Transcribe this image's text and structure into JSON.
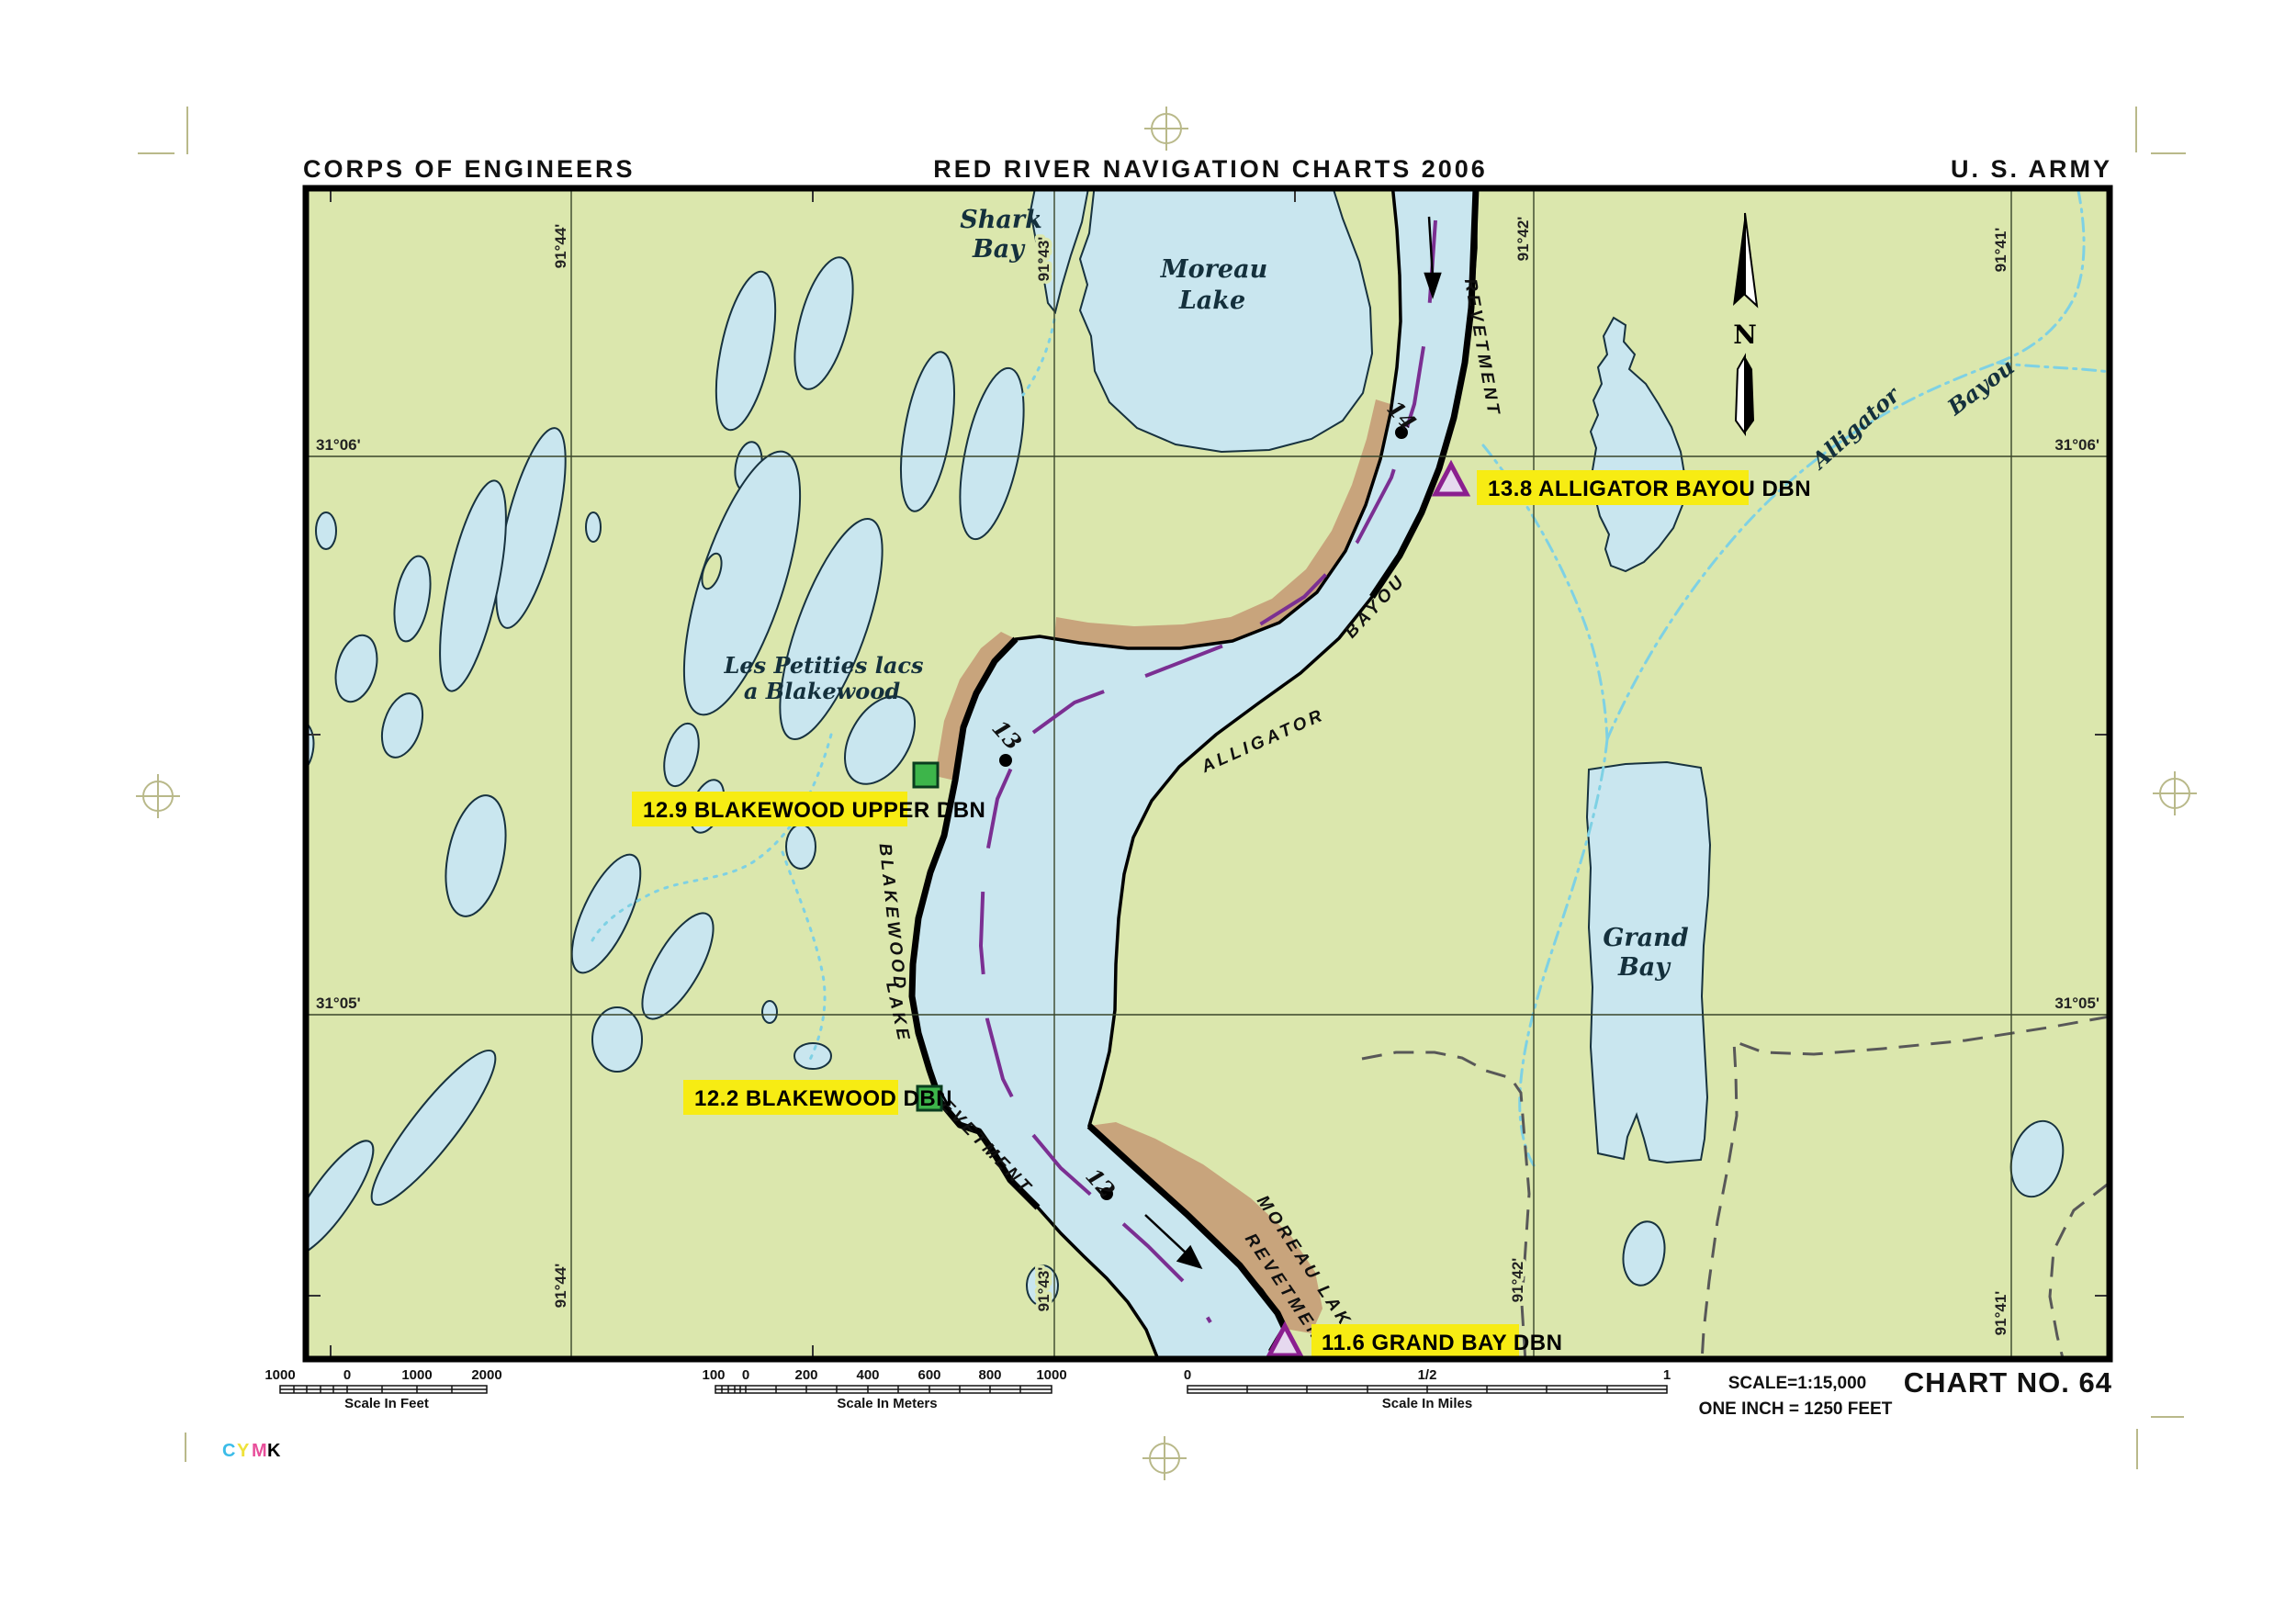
{
  "header": {
    "left": "CORPS OF ENGINEERS",
    "center": "RED RIVER NAVIGATION CHARTS 2006",
    "right": "U. S. ARMY"
  },
  "footer": {
    "scale_text": "SCALE=1:15,000",
    "inch_text": "ONE INCH = 1250 FEET",
    "chart_no": "CHART NO. 64",
    "cymk": {
      "c": "C",
      "y": "Y",
      "m": "M",
      "k": "K"
    }
  },
  "compass": {
    "north": "N"
  },
  "grid": {
    "lat": [
      "31°06'",
      "31°05'"
    ],
    "lon": [
      "91°44'",
      "91°43'",
      "91°42'",
      "91°41'"
    ]
  },
  "places": {
    "shark_bay": {
      "line1": "Shark",
      "line2": "Bay"
    },
    "moreau_lake": {
      "line1": "Moreau",
      "line2": "Lake"
    },
    "les_petities": {
      "line1": "Les Petities lacs",
      "line2": "a Blakewood"
    },
    "grand_bay": {
      "line1": "Grand",
      "line2": "Bay"
    }
  },
  "river": {
    "alligator": "ALLIGATOR",
    "bayou": "BAYOU",
    "revetment": "REVETMENT",
    "moreau_lake_rev": {
      "line1": "MOREAU LAKE",
      "line2": "REVETMENT"
    },
    "blakewood": "BLAKEWOOD",
    "lake": "LAKE",
    "miles": [
      "14",
      "13",
      "12"
    ]
  },
  "creek": {
    "alligator": "Alligator",
    "bayou": "Bayou"
  },
  "daybeacons": {
    "alligator_bayou": "13.8 ALLIGATOR BAYOU DBN",
    "blakewood_upper": "12.9 BLAKEWOOD UPPER DBN",
    "blakewood": "12.2 BLAKEWOOD DBN",
    "grand_bay": "11.6 GRAND BAY DBN"
  },
  "scalebars": {
    "feet": {
      "ticks": [
        "1000",
        "0",
        "1000",
        "2000"
      ],
      "caption": "Scale In Feet"
    },
    "meters": {
      "ticks": [
        "100",
        "0",
        "200",
        "400",
        "600",
        "800",
        "1000"
      ],
      "caption": "Scale In Meters"
    },
    "miles": {
      "ticks": [
        "0",
        "1/2",
        "1"
      ],
      "caption": "Scale In Miles"
    }
  },
  "colors": {
    "land": "#dbe7ad",
    "water": "#c9e6ef",
    "sand": "#c8a47c",
    "label_yellow": "#f7ec13",
    "channel_purple": "#7b2f92",
    "marker_green": "#3db54a",
    "creek_cyan": "#7ed1e4"
  }
}
